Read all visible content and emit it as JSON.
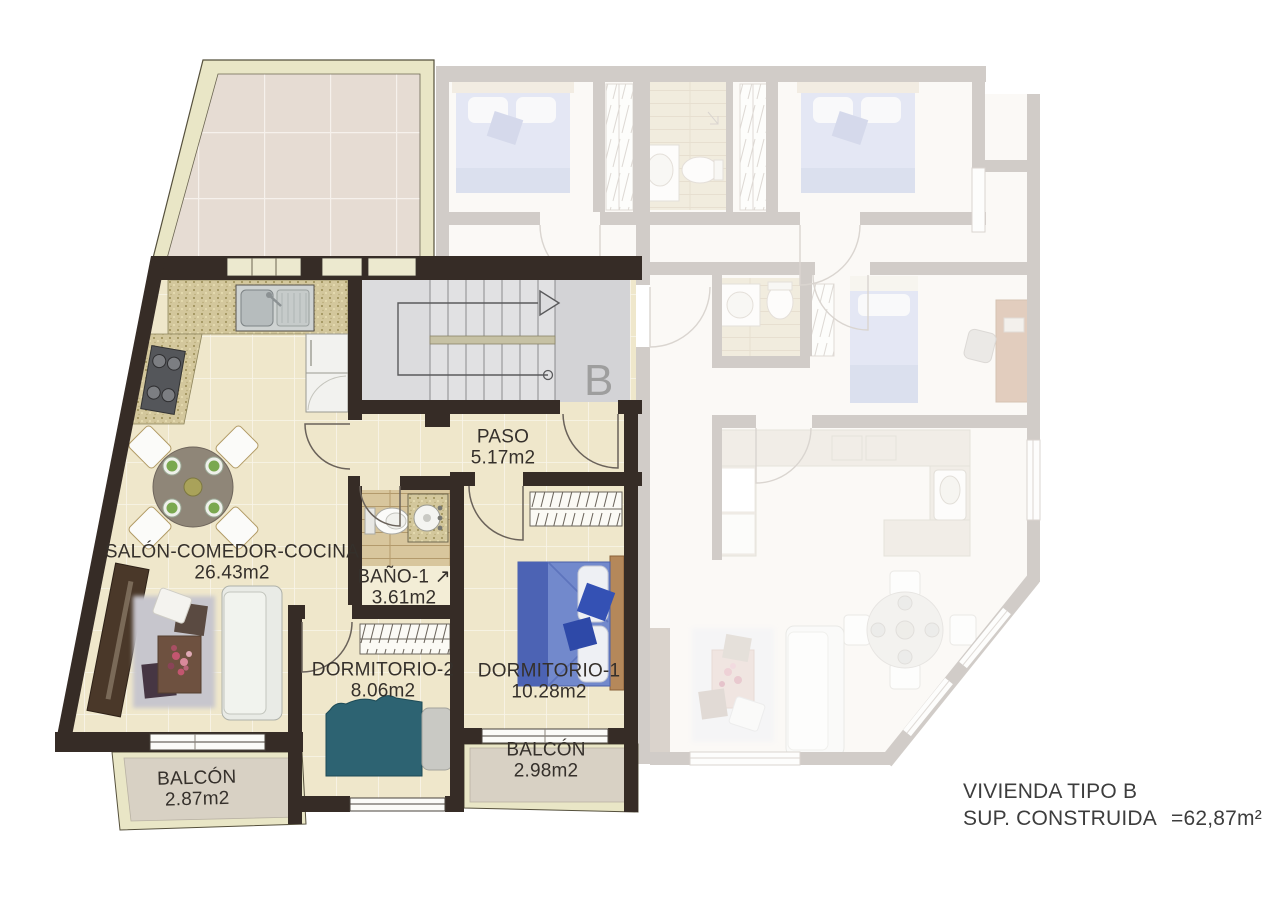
{
  "unit_letter": "B",
  "title_block": {
    "line1": "VIVIENDA TIPO B",
    "line2": "SUP. CONSTRUIDA",
    "value": "=62,87m²"
  },
  "rooms": [
    {
      "name": "SALÓN-COMEDOR-COCINA",
      "area": "26.43m2"
    },
    {
      "name": "PASO",
      "area": "5.17m2"
    },
    {
      "name": "BAÑO-1",
      "area": "3.61m2",
      "suffix": "↗"
    },
    {
      "name": "DORMITORIO-2",
      "area": "8.06m2"
    },
    {
      "name": "DORMITORIO-1",
      "area": "10.28m2"
    },
    {
      "name": "BALCÓN",
      "area": "2.87m2"
    },
    {
      "name": "BALCÓN",
      "area": "2.98m2"
    }
  ],
  "colors": {
    "wall": "#362c26",
    "faded_wall": "#a89f96",
    "floor": "#efe7cb",
    "terrace_rim": "#e9e6c6",
    "balcony_floor": "#d8d1c4",
    "stair_floor": "#dcdcde",
    "bed_blue": "#7289cc",
    "bed_teal": "#2d6372",
    "sofa": "#e9ebe6",
    "label_text": "#35302b",
    "title_text": "#3d3d3d",
    "stair_letter_color": "#9e9e9e"
  }
}
